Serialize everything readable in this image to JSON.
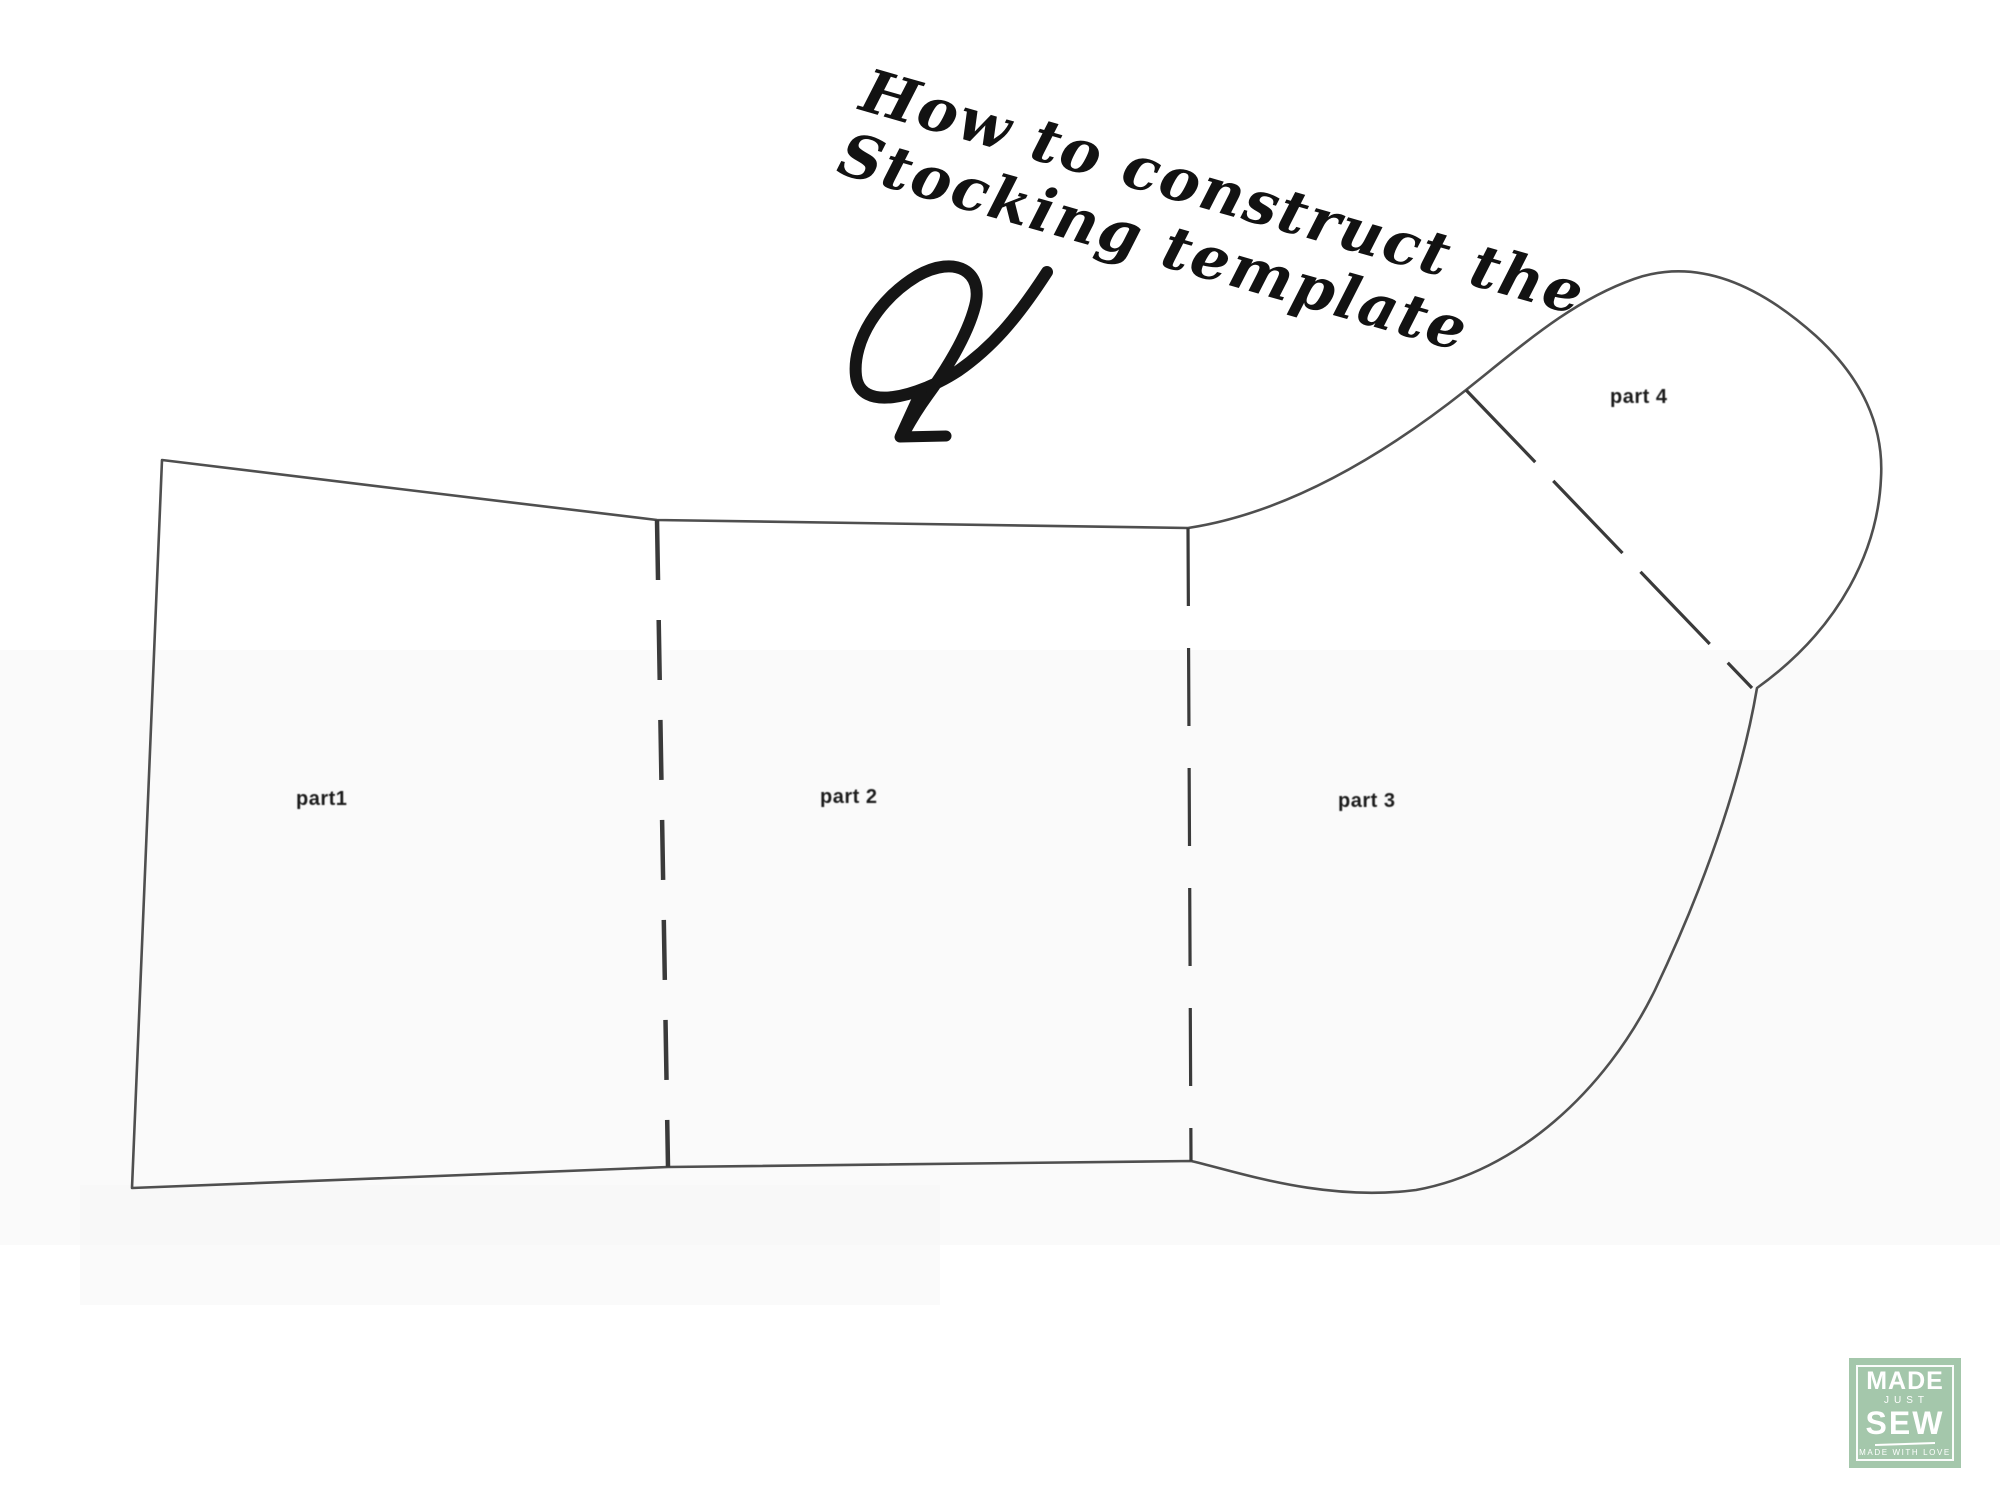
{
  "page": {
    "background": "#ffffff"
  },
  "title": {
    "line1": "How to construct the",
    "line2": "Stocking template",
    "ink_color": "#121212"
  },
  "arrow": {
    "description": "hand-drawn looped arrow pointing down-left",
    "color": "#151515"
  },
  "pattern": {
    "line_color": "#3c3c3c",
    "fold_line_style": "dashed",
    "labels": [
      {
        "text": "part1"
      },
      {
        "text": "part 2"
      },
      {
        "text": "part 3"
      },
      {
        "text": "part 4"
      }
    ]
  },
  "logo": {
    "word1": "MADE",
    "word2": "JUST",
    "word3": "SEW",
    "tagline": "MADE WITH LOVE",
    "bg_color": "#a4c7ab",
    "text_color": "#ffffff"
  }
}
